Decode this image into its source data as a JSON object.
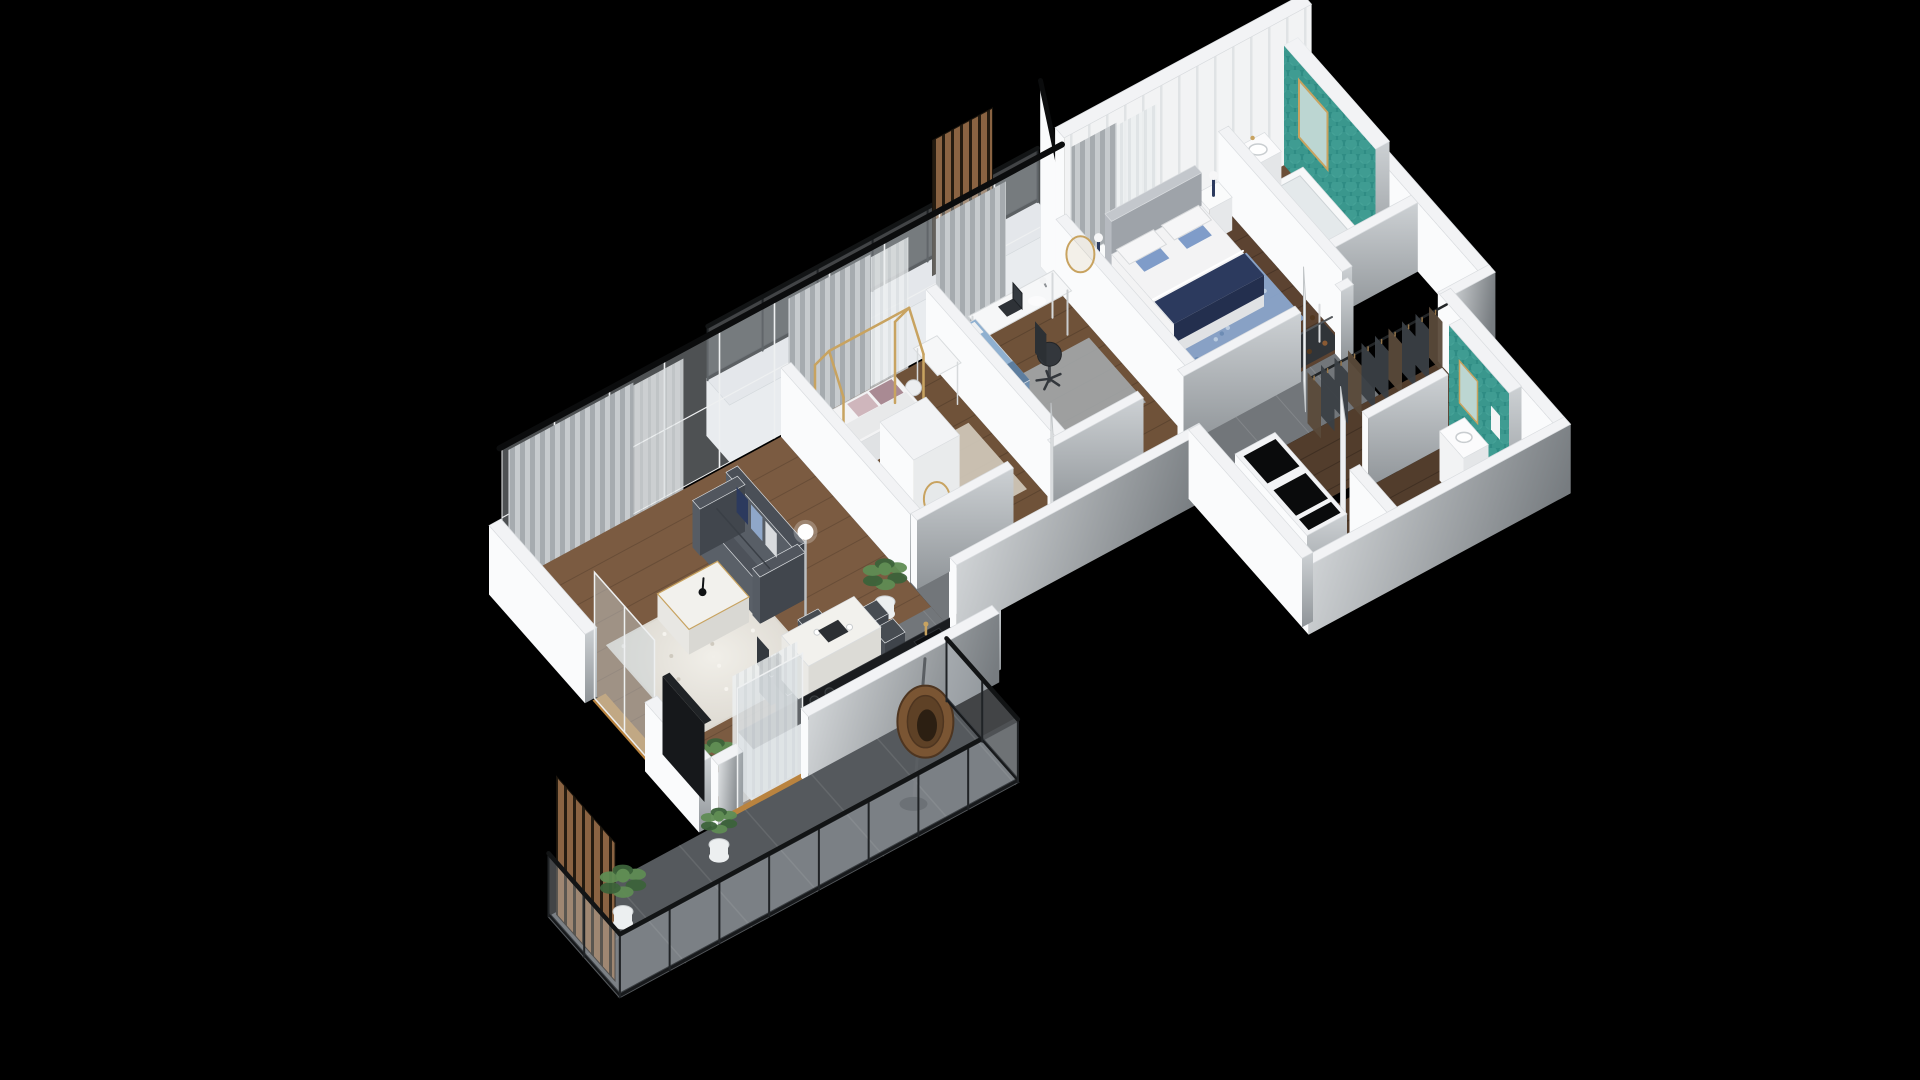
{
  "scene": {
    "background": "#000000"
  },
  "palette": {
    "wallTop": "#f2f3f5",
    "wallLight": "#fafbfc",
    "wallShadeA": "#cdd1d4",
    "wallShadeB": "#8f9498",
    "extShadeA": "#e0e3e5",
    "extShadeB": "#777c80",
    "panelBase": "#f2f3f4",
    "panelLine": "#e0e3e5",
    "curtainA": "#c7cbce",
    "curtainB": "#a6abaf",
    "sheerA": "#eceff0",
    "sheerB": "#dde1e3",
    "glass": "#cdd5d9",
    "beam": "#0b0c0d",
    "floorLiving": "#7b5b41",
    "floorKids": "#6f5239",
    "floorMaster": "#5c4331",
    "floorBath": "#6b4e37",
    "floorCorridor": "#523d2c",
    "tileHall": "#72767a",
    "tileBalcony": "#55595d",
    "woodSlat": "#8a6342",
    "slatGap": "#241b10",
    "teal": "#2f8c84",
    "tealLight": "#52b0a4",
    "navy": "#2c3a5e",
    "sofaTop": "#4d525a",
    "sofaFront": "#3f444c",
    "sofaLight": "#5a6068",
    "rugWhiteA": "#f1efe9",
    "rugWhiteB": "#dbd7cf",
    "rugBeige": "#cdc5b6",
    "rugBlue": "#8aa7cd",
    "rugGray": "#a2a6a8",
    "marble": "#f2f1ed",
    "gold": "#c8a360",
    "counterTop": "#1a1c1f",
    "cabinet": "#eef0f1",
    "bedWhite": "#f3f3f4",
    "bedSide": "#e0e2e4",
    "headboard": "#b6bac0",
    "doorWhite": "#eef0f2",
    "shelfDark": "#303438",
    "tvDark": "#16181b",
    "plantDark": "#3c633a",
    "plantLight": "#5f8c53",
    "potWhite": "#eceff0",
    "rattan": "#7a5533",
    "rattanDark": "#4e3520",
    "black": "#121415",
    "threshold": "#b9833f"
  },
  "rooms": [
    {
      "name": "balcony"
    },
    {
      "name": "living-dining-kitchen"
    },
    {
      "name": "kids-bedroom"
    },
    {
      "name": "office-bedroom"
    },
    {
      "name": "master-bedroom"
    },
    {
      "name": "main-bathroom"
    },
    {
      "name": "hallway"
    },
    {
      "name": "entry-hall"
    },
    {
      "name": "walk-in-wardrobe"
    },
    {
      "name": "second-bathroom"
    },
    {
      "name": "upper-ledge-balcony"
    }
  ],
  "furniture": {
    "balcony": [
      "glass-railing",
      "wood-slat-screen",
      "hanging-egg-chair",
      "potted-plants",
      "gray-tile-floor"
    ],
    "living-dining-kitchen": [
      "sofa",
      "navy-cushions",
      "marble-coffee-table",
      "swan-decor",
      "floor-lamp",
      "white-shag-rug",
      "tv-panel",
      "dining-table",
      "dining-chairs",
      "kitchen-counter",
      "induction-cooktop",
      "sink-gold-faucet",
      "palm-plants",
      "curtains"
    ],
    "kids-bedroom": [
      "house-frame-bed",
      "pillows",
      "beige-rug",
      "wardrobe-round-mirror",
      "desk",
      "chair"
    ],
    "office-bedroom": [
      "desk",
      "laptop",
      "desk-lamp",
      "office-chair",
      "single-bed-blue",
      "gray-rug",
      "gold-wall-art"
    ],
    "master-bedroom": [
      "double-bed",
      "navy-throw",
      "upholstered-headboard",
      "nightstands",
      "table-lamps",
      "blue-rug",
      "open-closet-shoe-shelves",
      "curtains"
    ],
    "main-bathroom": [
      "teal-scale-tile-wall",
      "bathtub",
      "vanity-sink",
      "mirror"
    ],
    "walk-in-wardrobe": [
      "hanging-rail",
      "clothes"
    ],
    "second-bathroom": [
      "teal-tile-wall",
      "vanity-sink",
      "door"
    ],
    "entry-hall": [
      "service-shafts"
    ],
    "hallway": [
      "gray-tile-floor",
      "door-leaves"
    ]
  }
}
